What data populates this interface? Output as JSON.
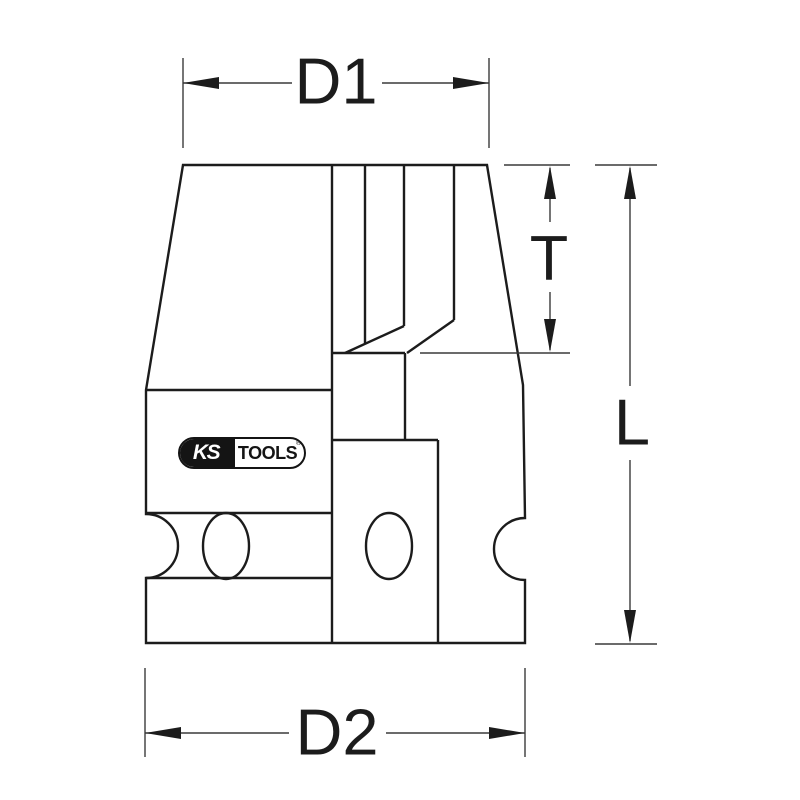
{
  "drawing": {
    "labels": {
      "d1": "D1",
      "d2": "D2",
      "t": "T",
      "l": "L"
    },
    "logo": {
      "ks": "KS",
      "tools": "TOOLS",
      "reg": "®"
    },
    "colors": {
      "background": "#ffffff",
      "part_line": "#1c1c1c",
      "dimension_line": "#3a3a3a",
      "label_text": "#1c1c1c",
      "logo_black": "#141414"
    }
  }
}
